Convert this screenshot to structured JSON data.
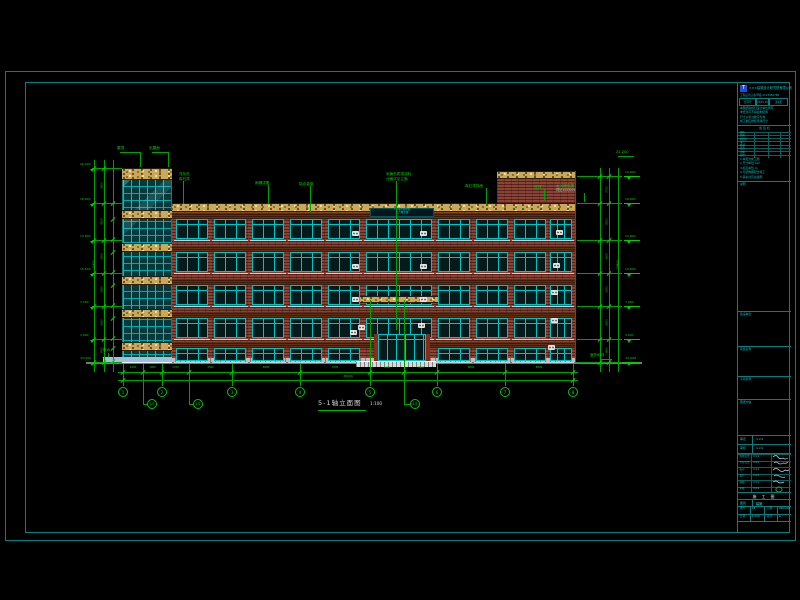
{
  "colors": {
    "frame": "#0c7d7d",
    "dim_line": "#00a000",
    "dim_bright": "#00d800",
    "cyan": "#00c4c4",
    "brick": "#8a4334",
    "band_yellow": "#c9a85c",
    "glass_teal": "#05393b",
    "white": "#d8d8d8",
    "ground": "#787878",
    "title_text": "#00c8c8",
    "bg": "#000000"
  },
  "drawing_title": {
    "text": "5-1轴立面图",
    "scale": "1:100"
  },
  "geo": {
    "frame_outer": {
      "x": 5,
      "y": 71,
      "w": 791,
      "h": 470
    },
    "frame_inner": {
      "x": 25,
      "y": 82,
      "w": 765,
      "h": 451
    },
    "ground": {
      "x1": 86,
      "x2": 642,
      "y": 362
    },
    "main": {
      "x1": 170,
      "x2": 575,
      "top": 203,
      "band_h": 9
    },
    "right_block": {
      "x1": 497,
      "x2": 575,
      "top": 171,
      "band_h": 8,
      "brick_to": 203
    },
    "tower": {
      "x1": 122,
      "x2": 172,
      "top": 168,
      "top_band_h": 12,
      "band_ys": [
        210,
        243,
        276,
        309,
        342
      ],
      "band_h": 9,
      "canopy": {
        "x1": 103,
        "y": 357,
        "h": 6
      }
    },
    "floors": [
      {
        "y": 219,
        "h": 20
      },
      {
        "y": 252,
        "h": 20
      },
      {
        "y": 285,
        "h": 20
      },
      {
        "y": 318,
        "h": 20
      },
      {
        "y": 348,
        "h": 13
      }
    ],
    "bays": [
      {
        "x": 176,
        "w": 32
      },
      {
        "x": 214,
        "w": 32
      },
      {
        "x": 252,
        "w": 32
      },
      {
        "x": 290,
        "w": 32
      },
      {
        "x": 328,
        "w": 32
      },
      {
        "x": 438,
        "w": 32
      },
      {
        "x": 476,
        "w": 32
      },
      {
        "x": 514,
        "w": 32
      },
      {
        "x": 550,
        "w": 22
      }
    ],
    "center": {
      "x": 366,
      "w": 66,
      "sign": {
        "x": 370,
        "y": 208,
        "w": 64,
        "h": 9,
        "lines": [
          "××市实验学校",
          "综合教学楼"
        ]
      },
      "canopy": {
        "x": 360,
        "y": 296,
        "w": 78,
        "h": 7
      },
      "entrance": {
        "x": 378,
        "y": 334,
        "w": 48,
        "h": 27,
        "cols": [
          374,
          426
        ],
        "steps": {
          "x": 356,
          "y": 361,
          "w": 80,
          "h": 6
        }
      }
    },
    "plinth": {
      "y": 358,
      "h": 4
    },
    "ac_units": [
      [
        352,
        231
      ],
      [
        420,
        231
      ],
      [
        556,
        230
      ],
      [
        352,
        264
      ],
      [
        420,
        264
      ],
      [
        553,
        263
      ],
      [
        352,
        297
      ],
      [
        420,
        297
      ],
      [
        551,
        290
      ],
      [
        350,
        330
      ],
      [
        418,
        323
      ],
      [
        551,
        318
      ],
      [
        548,
        345
      ],
      [
        358,
        325
      ]
    ]
  },
  "dims": {
    "left": {
      "ext_x": 92,
      "chains": [
        94,
        104,
        113
      ],
      "levels": [
        168,
        203,
        240,
        273,
        306,
        339,
        362
      ],
      "sub_levels": [
        203,
        219,
        239,
        252,
        272,
        285,
        305,
        318,
        338,
        348,
        361
      ],
      "chain_labels": [
        "3600",
        "4200",
        "3300",
        "3300",
        "3300",
        "3900"
      ],
      "overall": "20400",
      "flag_x": 86
    },
    "right": {
      "ext_x2": 622,
      "chains": [
        600,
        609,
        618
      ],
      "levels": [
        176,
        203,
        240,
        273,
        306,
        339,
        362
      ],
      "chain_labels": [
        "2700",
        "4200",
        "3300",
        "3300",
        "3300",
        "3900"
      ],
      "overall": "20400",
      "flag_x": 624
    },
    "levels": [
      {
        "y": 168,
        "v": "20.400",
        "sides": "L"
      },
      {
        "y": 176,
        "v": "19.600",
        "sides": "R"
      },
      {
        "y": 203,
        "v": "18.000",
        "sides": "LR"
      },
      {
        "y": 240,
        "v": "13.800",
        "sides": "LR"
      },
      {
        "y": 273,
        "v": "10.500",
        "sides": "LR"
      },
      {
        "y": 306,
        "v": "7.200",
        "sides": "LR"
      },
      {
        "y": 339,
        "v": "3.900",
        "sides": "LR"
      },
      {
        "y": 362,
        "v": "±0.000",
        "sides": "LR"
      }
    ],
    "bottom": {
      "y1": 372,
      "y2": 380,
      "x1": 118,
      "x2": 578,
      "ext_xs": [
        123,
        143,
        162,
        189,
        232,
        300,
        370,
        404,
        437,
        505,
        573
      ],
      "tall_xs": [
        370,
        404
      ],
      "seg_values": [
        "2000",
        "1900",
        "2700",
        "4300",
        "6800",
        "7000",
        "3400",
        "3300",
        "6800",
        "6800"
      ],
      "overall": "45000",
      "overall_x": 348
    }
  },
  "axes": {
    "y": 392,
    "main": [
      {
        "x": 123,
        "n": "1"
      },
      {
        "x": 162,
        "n": "2"
      },
      {
        "x": 232,
        "n": "3"
      },
      {
        "x": 300,
        "n": "4"
      },
      {
        "x": 370,
        "n": "5"
      },
      {
        "x": 437,
        "n": "6"
      },
      {
        "x": 505,
        "n": "7"
      },
      {
        "x": 573,
        "n": "8"
      }
    ],
    "offset": [
      {
        "from": 143,
        "x": 152,
        "y": 404,
        "n": "1/2"
      },
      {
        "from": 189,
        "x": 198,
        "y": 404,
        "n": "2/2"
      },
      {
        "from": 404,
        "x": 415,
        "y": 404,
        "n": "4/5"
      }
    ]
  },
  "notes": [
    {
      "x": 117,
      "y": 146,
      "lines": [
        "屋顶"
      ],
      "leader": [
        [
          120,
          152
        ],
        [
          140,
          152
        ],
        [
          140,
          167
        ]
      ]
    },
    {
      "x": 149,
      "y": 146,
      "lines": [
        "出屋面"
      ],
      "leader": [
        [
          152,
          152
        ],
        [
          168,
          152
        ],
        [
          168,
          167
        ]
      ]
    },
    {
      "x": 179,
      "y": 172,
      "lines": [
        "浅灰色",
        "真石漆"
      ],
      "leader": [
        [
          183,
          181
        ],
        [
          183,
          204
        ]
      ]
    },
    {
      "x": 255,
      "y": 181,
      "lines": [
        "雨棚详图"
      ],
      "leader": [
        [
          268,
          185
        ],
        [
          268,
          204
        ]
      ]
    },
    {
      "x": 299,
      "y": 182,
      "lines": [
        "铝合金窗"
      ],
      "leader": [
        [
          310,
          186
        ],
        [
          310,
          212
        ]
      ]
    },
    {
      "x": 386,
      "y": 172,
      "lines": [
        "米黄色质感涂料",
        "分格详见立面"
      ],
      "leader": [
        [
          396,
          181
        ],
        [
          396,
          330
        ]
      ]
    },
    {
      "x": 465,
      "y": 184,
      "lines": [
        "真石漆饰面"
      ],
      "leader": [
        [
          486,
          188
        ],
        [
          486,
          204
        ]
      ]
    },
    {
      "x": 534,
      "y": 185,
      "lines": [
        "压顶"
      ],
      "leader": [
        [
          544,
          189
        ],
        [
          544,
          200
        ]
      ]
    },
    {
      "x": 556,
      "y": 184,
      "lines": [
        "女儿墙压顶"
      ],
      "white": "详见12ZJ001",
      "leader": [
        [
          584,
          193
        ],
        [
          584,
          202
        ]
      ]
    },
    {
      "x": 616,
      "y": 150,
      "lines": [
        "22.200"
      ],
      "leader": [
        [
          618,
          156
        ],
        [
          634,
          156
        ]
      ]
    },
    {
      "x": 590,
      "y": 353,
      "lines": [
        "室外地坪"
      ],
      "leader": [
        [
          600,
          359
        ],
        [
          612,
          359
        ]
      ]
    },
    {
      "x": 103,
      "y": 348,
      "lines": [
        "散水"
      ],
      "leader": [
        [
          108,
          353
        ],
        [
          108,
          357
        ]
      ]
    }
  ],
  "title_block": {
    "logo_text": "×××建筑设计研究院有限公司",
    "cert_line": "工程设计证书 甲级 A123456789",
    "boxes": [
      "合同号",
      "2023-15",
      "第1册"
    ],
    "info_lines": [
      "本图纸版权归设计单位所有",
      "未经许可不得复制使用",
      "尺寸以标注数字为准",
      "施工前应校核现场尺寸"
    ],
    "sign_table": {
      "header": "会 签 栏",
      "rows": [
        "建筑",
        "结构",
        "给排水",
        "电气",
        "暖通",
        "动力",
        "总图",
        "技经"
      ]
    },
    "notes": [
      "1.本页为施工图",
      "2.尺寸单位:mm",
      "3.标高单位:m",
      "4.与结构图配合施工",
      "5.其余详见总说明"
    ],
    "section_labels": [
      "说明",
      "建设单位",
      "项目名称",
      "子项名称",
      "图纸内容"
    ],
    "section_label_ys": [
      100,
      230,
      265,
      295,
      318
    ],
    "approve_rows": [
      {
        "label": "审定",
        "value": "×××"
      },
      {
        "label": "审核",
        "value": "×××"
      }
    ],
    "sig_rows": [
      {
        "label": "项目负责",
        "value": "×××"
      },
      {
        "label": "专业负责",
        "value": "×××"
      },
      {
        "label": "校对",
        "value": "×××"
      },
      {
        "label": "设计",
        "value": "×××"
      },
      {
        "label": "制图",
        "value": "×××"
      },
      {
        "label": "复核",
        "value": "×××"
      }
    ],
    "stage": "施 工 图",
    "proj_row": {
      "label": "图别",
      "value": "建施"
    },
    "bottom_rows": [
      [
        {
          "l": "图号",
          "v": "15"
        },
        {
          "l": "日期",
          "v": "2023.06"
        }
      ],
      [
        {
          "l": "比例",
          "v": "1:100"
        },
        {
          "l": "版次",
          "v": "A"
        }
      ]
    ]
  }
}
